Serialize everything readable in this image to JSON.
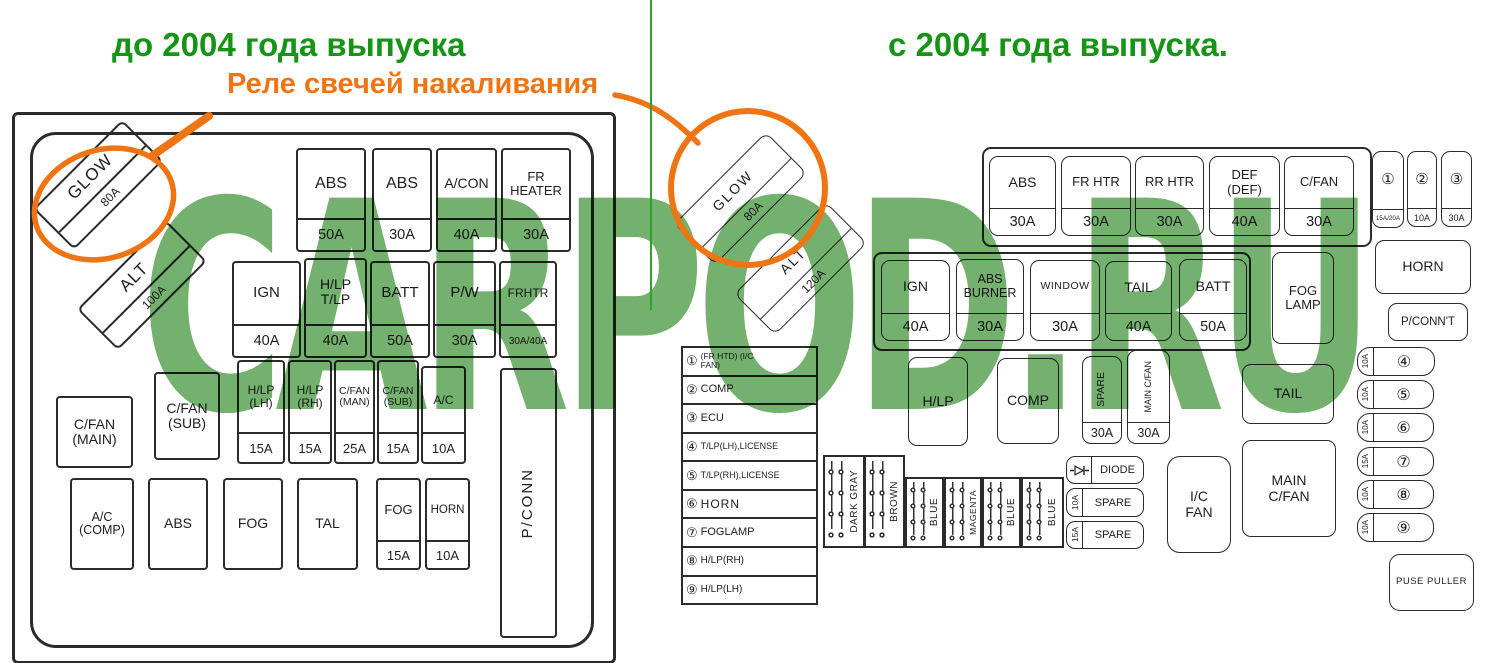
{
  "header": {
    "left_title": "до 2004 года выпуска",
    "glow_annotation": "Реле свечей накаливания",
    "right_title": "с 2004 года выпуска.",
    "watermark": "CARPOD.RU"
  },
  "colors": {
    "title_green": "#169416",
    "annotation_orange": "#ee7414",
    "watermark_green": "#74b06e",
    "divider_green": "#2da02d",
    "diagram_line": "#2b2b2b"
  },
  "left_box": {
    "glow": {
      "label": "GLOW",
      "amp": "80A"
    },
    "alt": {
      "label": "ALT",
      "amp": "100A"
    },
    "row1": [
      {
        "label": "ABS",
        "amp": "50A"
      },
      {
        "label": "ABS",
        "amp": "30A"
      },
      {
        "label": "A/CON",
        "amp": "40A"
      },
      {
        "label": "FR HEATER",
        "amp": "30A"
      }
    ],
    "row2": [
      {
        "label": "IGN",
        "amp": "40A"
      },
      {
        "label": "H/LP T/LP",
        "amp": "40A"
      },
      {
        "label": "BATT",
        "amp": "50A"
      },
      {
        "label": "P/W",
        "amp": "30A"
      },
      {
        "label": "FRHTR",
        "amp": "30A/40A"
      }
    ],
    "row3": [
      {
        "label": "C/FAN (MAIN)"
      },
      {
        "label": "C/FAN (SUB)"
      },
      {
        "label": "H/LP (LH)",
        "amp": "15A"
      },
      {
        "label": "H/LP (RH)",
        "amp": "15A"
      },
      {
        "label": "C/FAN (MAN)",
        "amp": "25A"
      },
      {
        "label": "C/FAN (SUB)",
        "amp": "15A"
      },
      {
        "label": "A/C",
        "amp": "10A"
      }
    ],
    "pconn": "P/CONN",
    "row4": [
      {
        "label": "A/C (COMP)"
      },
      {
        "label": "ABS"
      },
      {
        "label": "FOG"
      },
      {
        "label": "TAL"
      },
      {
        "label": "FOG",
        "amp": "15A"
      },
      {
        "label": "HORN",
        "amp": "10A"
      }
    ]
  },
  "right_box": {
    "glow": {
      "label": "GLOW",
      "amp": "80A"
    },
    "alt": {
      "label": "ALT",
      "amp": "120A"
    },
    "top_row": [
      {
        "label": "ABS",
        "amp": "30A"
      },
      {
        "label": "FR HTR",
        "amp": "30A"
      },
      {
        "label": "RR HTR",
        "amp": "30A"
      },
      {
        "label": "DEF (DEF)",
        "amp": "40A"
      },
      {
        "label": "C/FAN",
        "amp": "30A"
      }
    ],
    "mini_fuses": [
      {
        "num": "①",
        "amp": "15A/20A"
      },
      {
        "num": "②",
        "amp": "10A"
      },
      {
        "num": "③",
        "amp": "30A"
      }
    ],
    "horn": "HORN",
    "pconnt": "P/CONN'T",
    "row2": [
      {
        "label": "IGN",
        "amp": "40A"
      },
      {
        "label": "ABS BURNER",
        "amp": "30A"
      },
      {
        "label": "WINDOW",
        "amp": "30A"
      },
      {
        "label": "TAIL",
        "amp": "40A"
      },
      {
        "label": "BATT",
        "amp": "50A"
      }
    ],
    "fog_lamp": "FOG LAMP",
    "legend": [
      {
        "num": "①",
        "label": "(FR HTD) (I/C FAN)"
      },
      {
        "num": "②",
        "label": "COMP"
      },
      {
        "num": "③",
        "label": "ECU"
      },
      {
        "num": "④",
        "label": "T/LP(LH),LICENSE"
      },
      {
        "num": "⑤",
        "label": "T/LP(RH),LICENSE"
      },
      {
        "num": "⑥",
        "label": "HORN"
      },
      {
        "num": "⑦",
        "label": "FOGLAMP"
      },
      {
        "num": "⑧",
        "label": "H/LP(RH)"
      },
      {
        "num": "⑨",
        "label": "H/LP(LH)"
      }
    ],
    "hlp": "H/LP",
    "comp": "COMP",
    "spare_vertical": {
      "label": "SPARE",
      "amp": "30A"
    },
    "main_cfan_vertical": {
      "label": "MAIN C/FAN",
      "amp": "30A"
    },
    "tail": "TAIL",
    "main_cfan": "MAIN C/FAN",
    "wires": [
      "DARK GRAY",
      "BROWN",
      "BLUE",
      "MAGENTA",
      "BLUE",
      "BLUE"
    ],
    "diode": "DIODE",
    "spares": [
      {
        "amp": "10A",
        "label": "SPARE"
      },
      {
        "amp": "15A",
        "label": "SPARE"
      }
    ],
    "ic_fan": "I/C FAN",
    "fuse_column": [
      {
        "num": "④",
        "amp": "10A"
      },
      {
        "num": "⑤",
        "amp": "10A"
      },
      {
        "num": "⑥",
        "amp": "10A"
      },
      {
        "num": "⑦",
        "amp": "15A"
      },
      {
        "num": "⑧",
        "amp": "10A"
      },
      {
        "num": "⑨",
        "amp": "10A"
      }
    ],
    "fuse_puller": "PUSE PULLER"
  }
}
